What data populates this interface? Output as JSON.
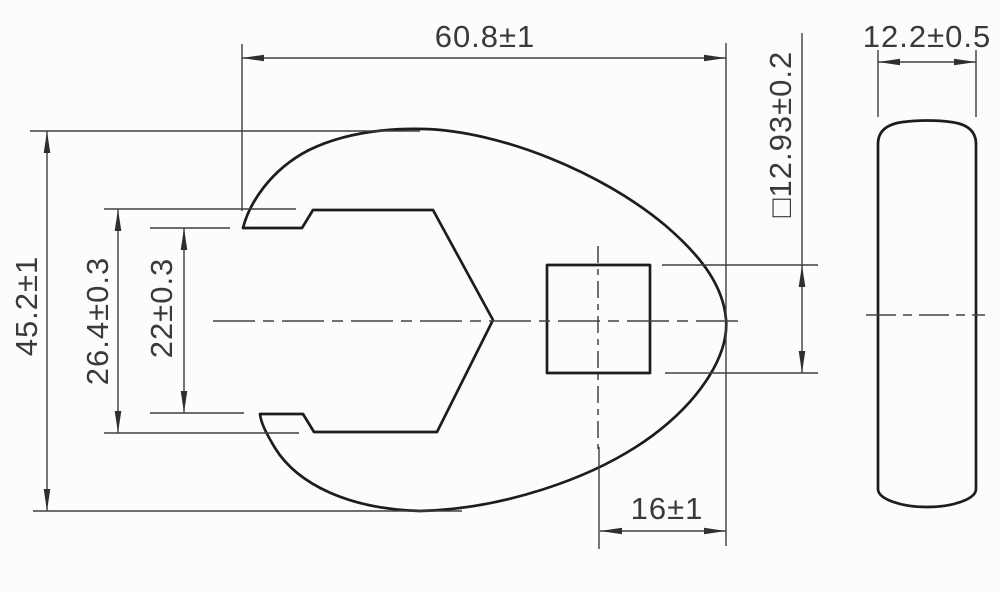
{
  "drawing": {
    "dimensions": {
      "overall_width": "60.8±1",
      "thickness": "12.2±0.5",
      "square_drive": "□12.93±0.2",
      "overall_height": "45.2±1",
      "jaw_inner_width": "26.4±0.3",
      "jaw_opening": "22±0.3",
      "drive_to_tip": "16±1"
    },
    "colors": {
      "background": "#fcfcfb",
      "outline": "#1d1d1d",
      "dimension_line": "#3e3e3e",
      "text": "#3a3a3a"
    }
  }
}
